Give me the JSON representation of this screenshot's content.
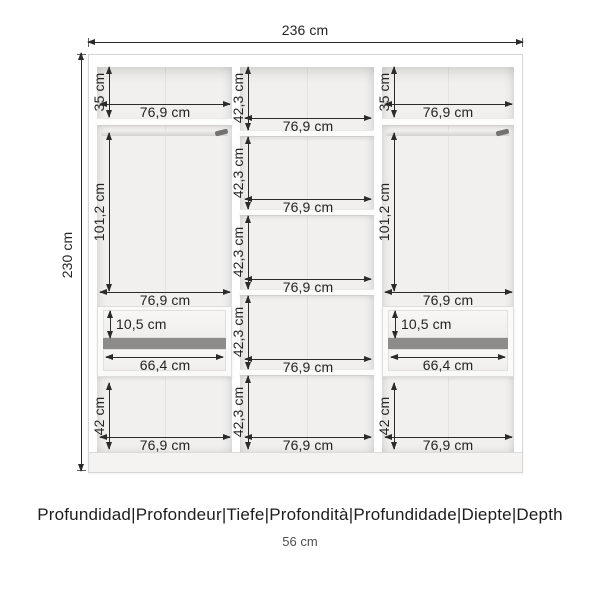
{
  "colors": {
    "dimension": "#2b2b2b",
    "interior": "#f1f0ee",
    "panel": "#ffffff",
    "drawer_gap": "#8e8c8a"
  },
  "overall": {
    "width": "236 cm",
    "height": "230 cm"
  },
  "columns": {
    "left": {
      "top": {
        "height": "35 cm",
        "width": "76,9 cm"
      },
      "hanging": {
        "height": "101,2 cm",
        "width": "76,9 cm"
      },
      "drawers": {
        "front_height": "10,5 cm",
        "inner_width": "66,4 cm"
      },
      "bottom": {
        "height": "42 cm",
        "width": "76,9 cm"
      }
    },
    "middle": {
      "sections": [
        {
          "height": "42,3 cm",
          "width": "76,9 cm"
        },
        {
          "height": "42,3 cm",
          "width": "76,9 cm"
        },
        {
          "height": "42,3 cm",
          "width": "76,9 cm"
        },
        {
          "height": "42,3 cm",
          "width": "76,9 cm"
        },
        {
          "height": "42,3 cm",
          "width": "76,9 cm"
        }
      ]
    },
    "right": {
      "top": {
        "height": "35 cm",
        "width": "76,9 cm"
      },
      "hanging": {
        "height": "101,2 cm",
        "width": "76,9 cm"
      },
      "drawers": {
        "front_height": "10,5 cm",
        "inner_width": "66,4 cm"
      },
      "bottom": {
        "height": "42 cm",
        "width": "76,9 cm"
      }
    }
  },
  "footer": {
    "depth_labels": "Profundidad|Profondeur|Tiefe|Profondità|Profundidade|Diepte|Depth",
    "depth_value": "56 cm"
  }
}
